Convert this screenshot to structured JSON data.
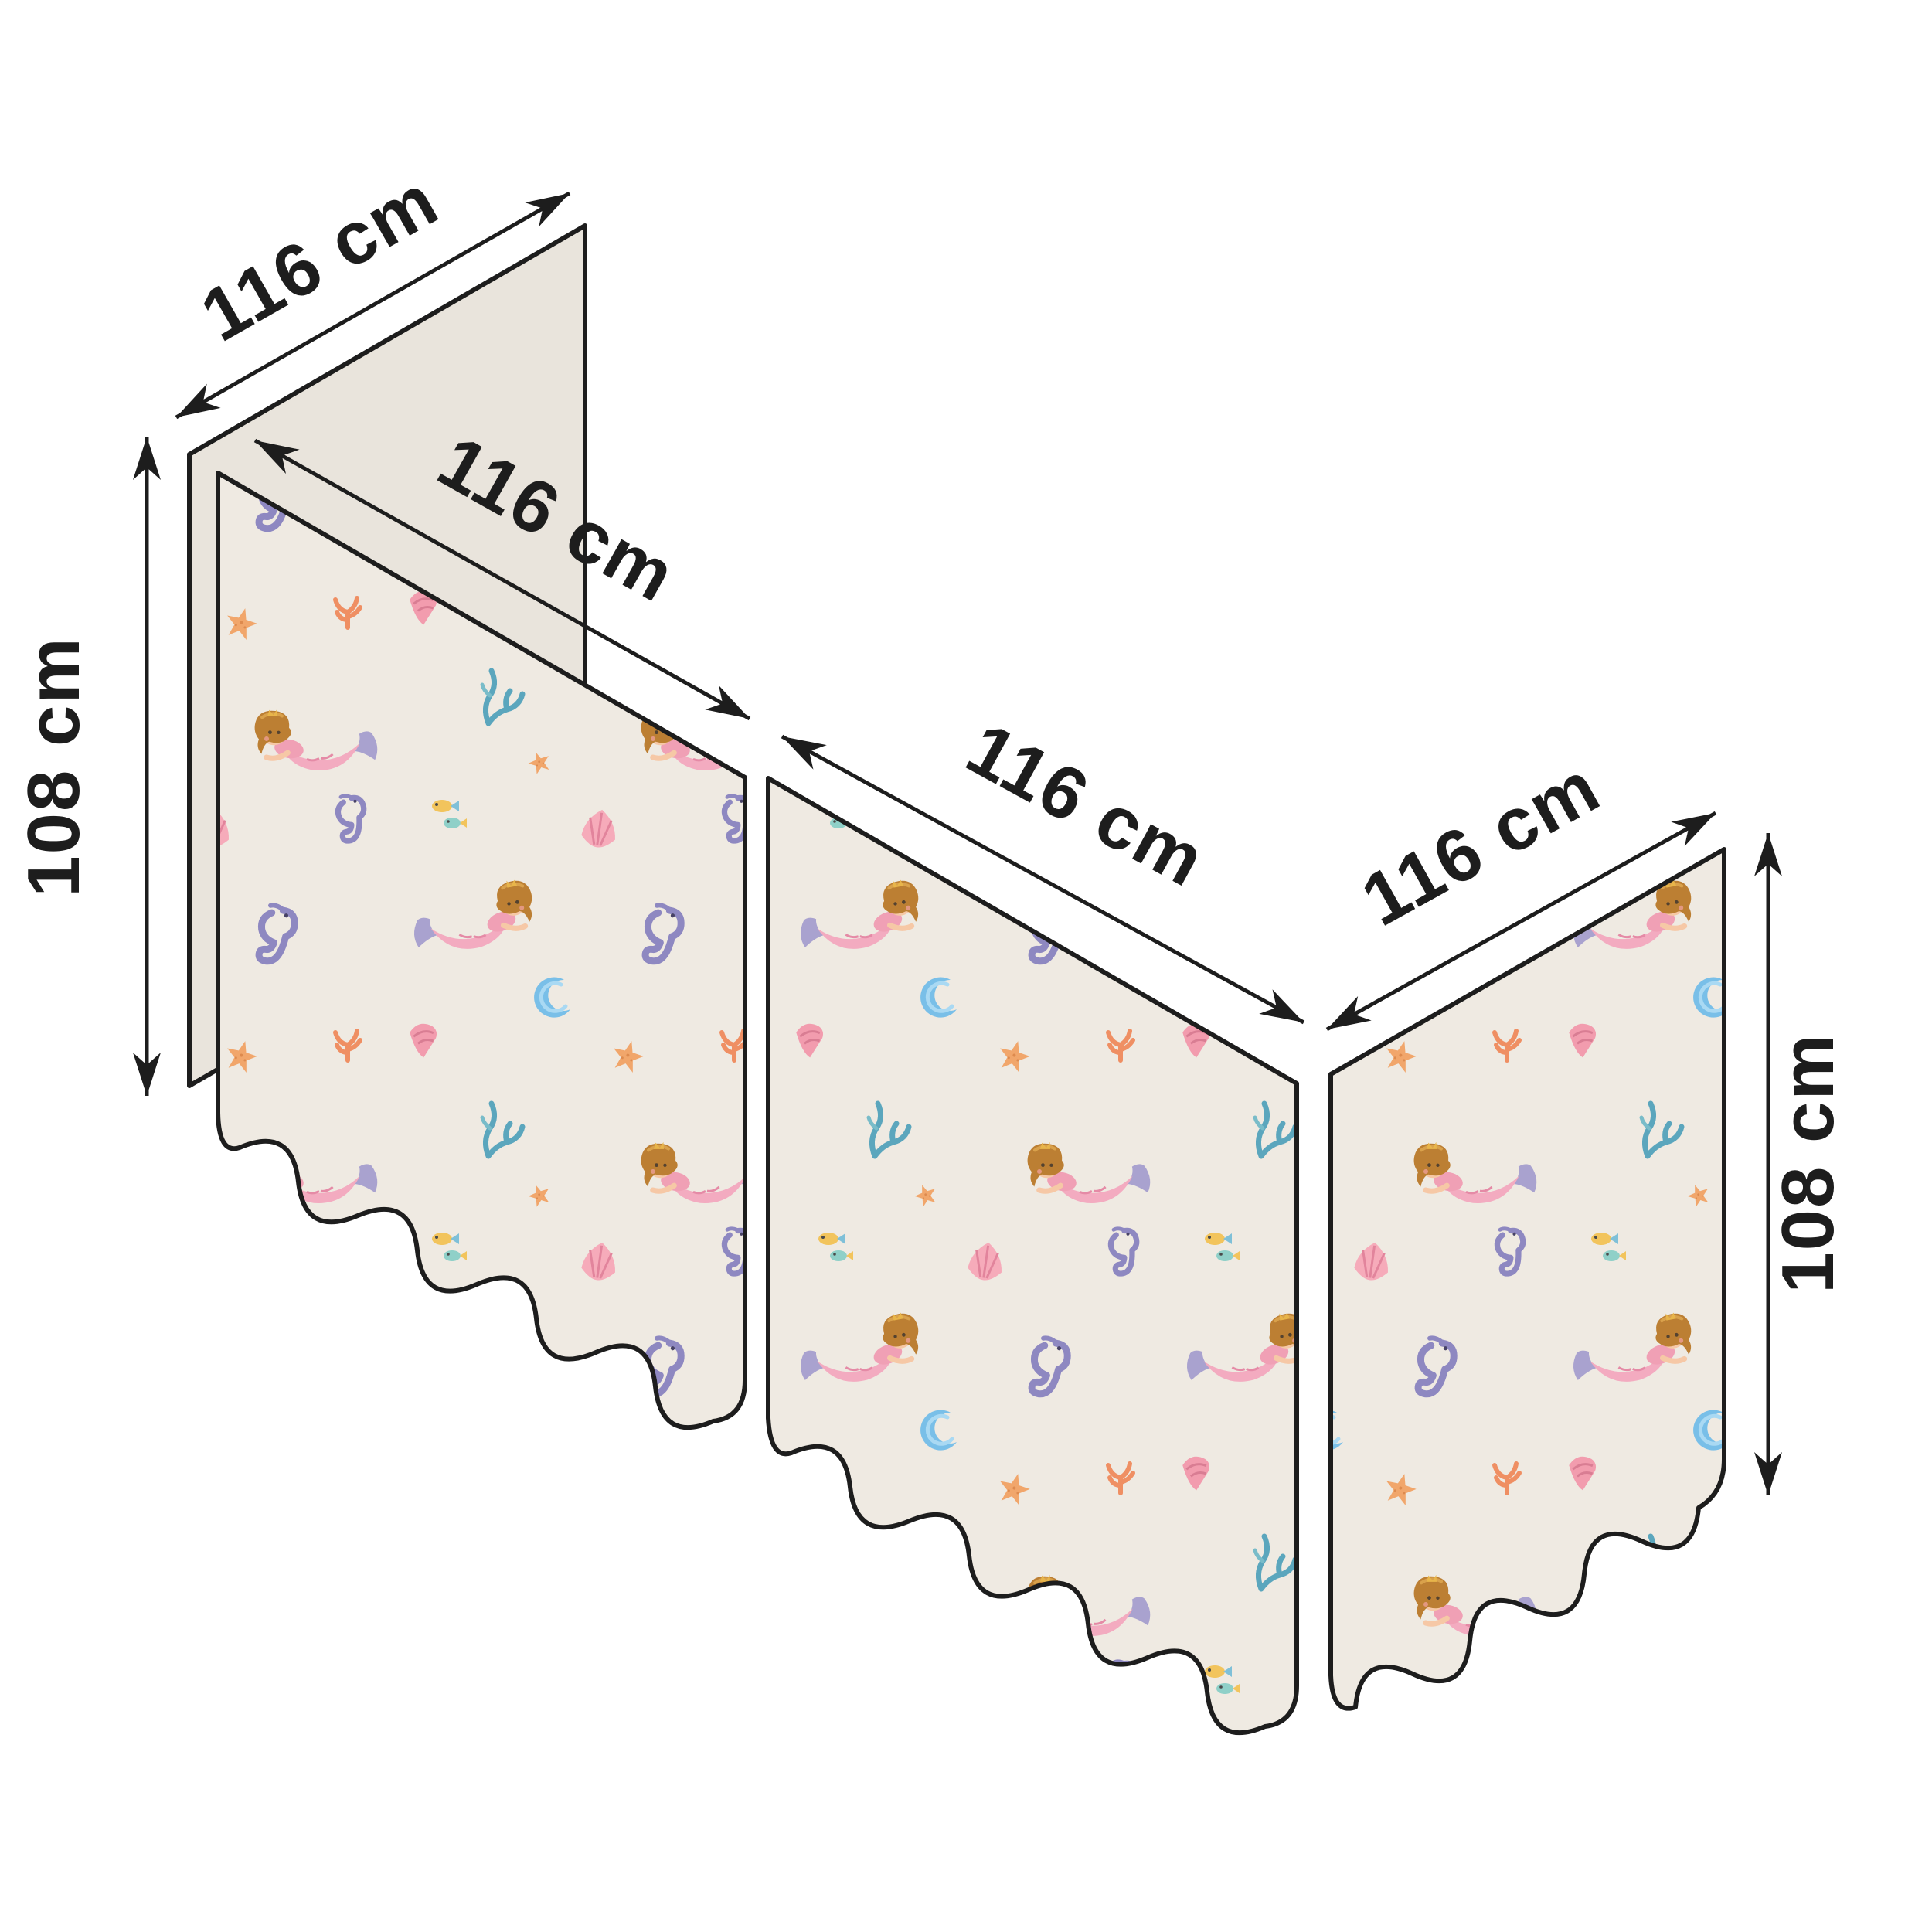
{
  "diagram": {
    "title": "bed-curtain-dimension-diagram",
    "labels": {
      "back_panel_width": "116 cm",
      "left_height": "108 cm",
      "left_panel_width": "116 cm",
      "front_panel_width": "116 cm",
      "right_panel_width": "116 cm",
      "right_height": "108 cm"
    },
    "panels": [
      {
        "id": "back-side-panel",
        "style": "plain",
        "width": "116 cm",
        "height": "108 cm"
      },
      {
        "id": "left-curtain-panel",
        "style": "mermaid-pattern",
        "width": "116 cm",
        "height": "108 cm"
      },
      {
        "id": "front-curtain-panel",
        "style": "mermaid-pattern",
        "width": "116 cm"
      },
      {
        "id": "right-curtain-panel",
        "style": "mermaid-pattern",
        "width": "116 cm",
        "height": "108 cm"
      }
    ],
    "colors": {
      "panel_plain": "#e9e4dc",
      "panel_pattern_bg": "#efeae2",
      "outline": "#1d1d1d",
      "dimension_line": "#1d1d1d",
      "label_text": "#1d1d1d"
    },
    "pattern_motifs": [
      "mermaid",
      "seahorse",
      "starfish",
      "shell",
      "cone-shell",
      "coral",
      "seaweed",
      "bubble-wave",
      "fish"
    ]
  }
}
